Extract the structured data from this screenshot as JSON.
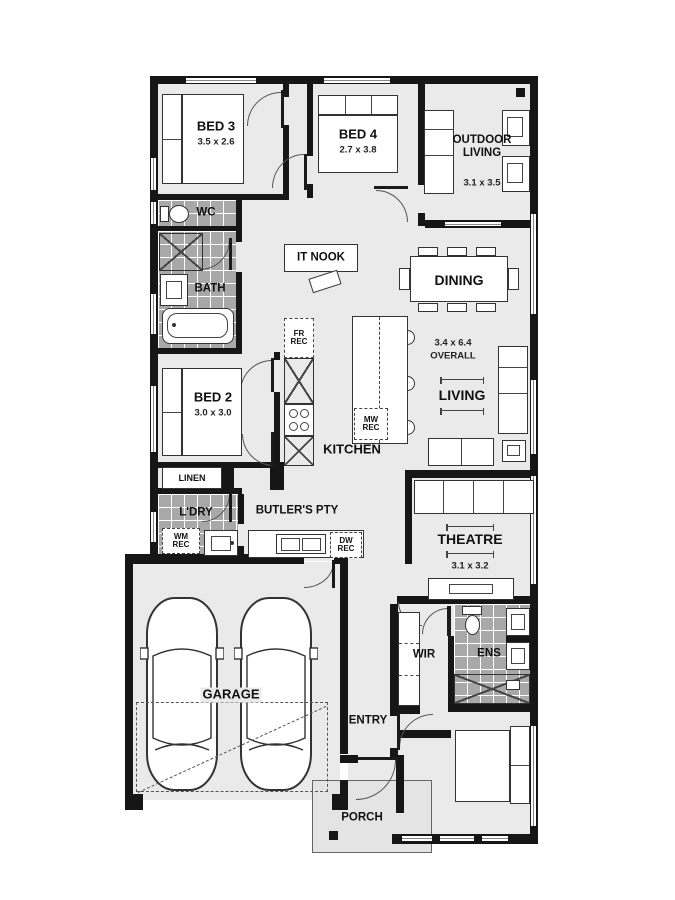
{
  "plan_title": "single-storey house floor plan",
  "rooms": {
    "bed3": {
      "label": "BED 3",
      "dims": "3.5 x 2.6"
    },
    "bed4": {
      "label": "BED 4",
      "dims": "2.7 x 3.8"
    },
    "outdoor_living": {
      "label": "OUTDOOR\nLIVING",
      "dims": "3.1 x 3.5"
    },
    "wc": {
      "label": "WC"
    },
    "it_nook": {
      "label": "IT NOOK"
    },
    "dining": {
      "label": "DINING"
    },
    "bath": {
      "label": "BATH"
    },
    "bed2": {
      "label": "BED 2",
      "dims": "3.0 x 3.0"
    },
    "living": {
      "label": "LIVING"
    },
    "overall": {
      "line1": "3.4 x 6.4",
      "line2": "OVERALL"
    },
    "kitchen": {
      "label": "KITCHEN"
    },
    "linen": {
      "label": "LINEN"
    },
    "ldry": {
      "label": "L'DRY"
    },
    "butlers": {
      "label": "BUTLER'S PTY"
    },
    "theatre": {
      "label": "THEATRE",
      "dims": "3.1 x 3.2"
    },
    "garage": {
      "label": "GARAGE"
    },
    "wir": {
      "label": "WIR"
    },
    "ens": {
      "label": "ENS"
    },
    "entry": {
      "label": "ENTRY"
    },
    "bed1": {
      "label": "BED 1",
      "dims": "3.5 x 3.2"
    },
    "porch": {
      "label": "PORCH"
    }
  },
  "recesses": {
    "fridge": {
      "label": "FR\nREC"
    },
    "microwave": {
      "label": "MW\nREC"
    },
    "washing_machine": {
      "label": "WM\nREC"
    },
    "dishwasher": {
      "label": "DW\nREC"
    }
  },
  "colors": {
    "wall": "#161616",
    "floor": "#eaeaea",
    "wet_area_tile": "#a8a8a8",
    "furniture_line": "#333333",
    "background": "#ffffff"
  }
}
